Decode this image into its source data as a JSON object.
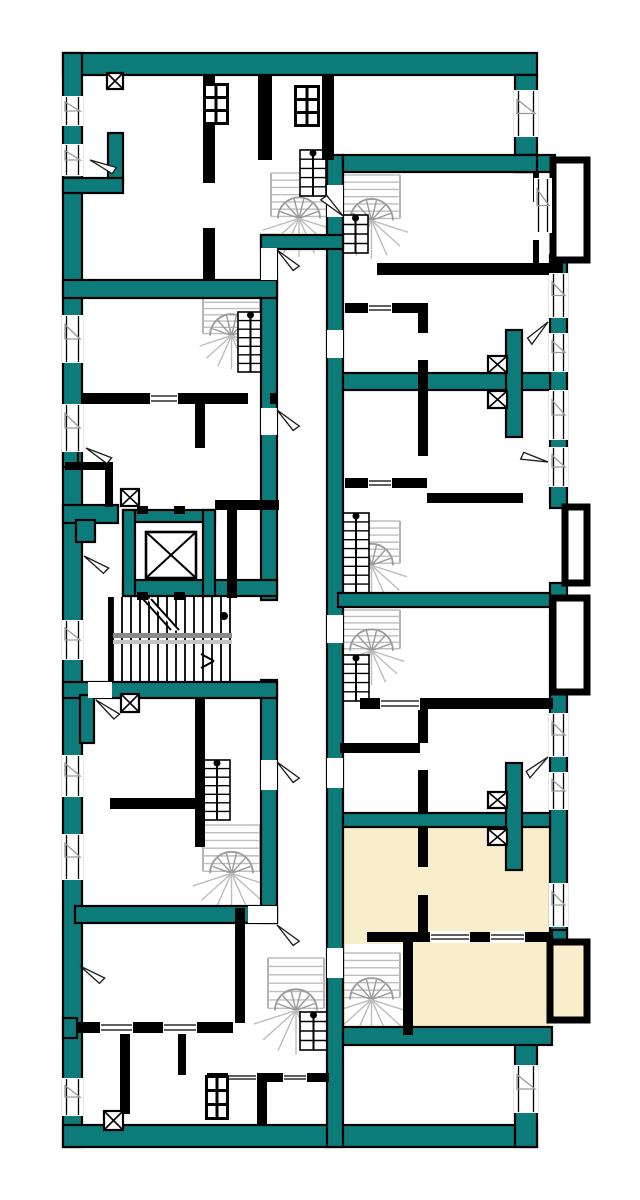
{
  "canvas": {
    "width": 640,
    "height": 1200,
    "background": "#ffffff"
  },
  "palette": {
    "wall_teal": "#0e7b7b",
    "wall_outline": "#000000",
    "wall_black": "#000000",
    "stair_gray": "#9a9a9a",
    "stair_light": "#bdbdbd",
    "rail_dark": "#8a8a8a",
    "rail_light": "#c4c4c4",
    "highlight_cream": "#f8eecb",
    "white": "#ffffff",
    "door_line": "#1a1a1a",
    "window_flag": "#9a9a9a"
  },
  "legend": {
    "teal_wall": "load-bearing-wall",
    "black_wall": "partition-wall",
    "cream_area": "highlighted-apartment",
    "x_box_small": "ventilation-shaft",
    "x_box_large": "elevator-shaft",
    "fan_symbol": "spiral-staircase",
    "tread_symbol": "main-staircase",
    "triangle_symbol": "door-swing",
    "double_line": "window"
  },
  "teal_walls": [
    [
      63,
      53,
      474,
      22
    ],
    [
      63,
      53,
      19,
      1094
    ],
    [
      63,
      1125,
      474,
      22
    ],
    [
      515,
      75,
      22,
      97
    ],
    [
      515,
      155,
      40,
      17
    ],
    [
      550,
      255,
      17,
      253
    ],
    [
      550,
      583,
      17,
      360
    ],
    [
      515,
      1043,
      22,
      104
    ],
    [
      327,
      155,
      16,
      992
    ],
    [
      261,
      235,
      16,
      365
    ],
    [
      261,
      680,
      16,
      243
    ],
    [
      261,
      235,
      82,
      14
    ],
    [
      63,
      280,
      214,
      18
    ],
    [
      123,
      580,
      154,
      16
    ],
    [
      63,
      682,
      214,
      16
    ],
    [
      75,
      906,
      202,
      17
    ],
    [
      343,
      155,
      194,
      17
    ],
    [
      343,
      373,
      207,
      17
    ],
    [
      506,
      330,
      16,
      107
    ],
    [
      343,
      813,
      207,
      14
    ],
    [
      506,
      763,
      16,
      107
    ],
    [
      343,
      1027,
      209,
      18
    ],
    [
      338,
      593,
      212,
      14
    ],
    [
      108,
      133,
      15,
      50
    ],
    [
      63,
      178,
      60,
      15
    ],
    [
      63,
      450,
      15,
      17
    ],
    [
      63,
      505,
      55,
      18
    ],
    [
      76,
      520,
      19,
      22
    ],
    [
      80,
      695,
      14,
      48
    ],
    [
      63,
      1018,
      14,
      20
    ],
    [
      123,
      510,
      92,
      12
    ],
    [
      123,
      510,
      12,
      86
    ],
    [
      203,
      510,
      12,
      86
    ],
    [
      552,
      930,
      15,
      16
    ]
  ],
  "black_walls": [
    [
      203,
      75,
      12,
      108
    ],
    [
      203,
      228,
      12,
      52
    ],
    [
      258,
      75,
      14,
      85
    ],
    [
      322,
      75,
      12,
      85
    ],
    [
      377,
      263,
      186,
      12
    ],
    [
      345,
      303,
      75,
      10
    ],
    [
      418,
      303,
      10,
      30
    ],
    [
      418,
      360,
      10,
      30
    ],
    [
      345,
      478,
      82,
      10
    ],
    [
      418,
      390,
      10,
      66
    ],
    [
      427,
      493,
      96,
      10
    ],
    [
      533,
      172,
      6,
      30
    ],
    [
      533,
      240,
      6,
      25
    ],
    [
      360,
      698,
      193,
      11
    ],
    [
      418,
      709,
      10,
      34
    ],
    [
      418,
      770,
      10,
      43
    ],
    [
      340,
      743,
      80,
      10
    ],
    [
      418,
      827,
      10,
      40
    ],
    [
      418,
      895,
      10,
      37
    ],
    [
      367,
      932,
      186,
      10
    ],
    [
      403,
      942,
      10,
      93
    ],
    [
      82,
      393,
      166,
      11
    ],
    [
      270,
      393,
      7,
      11
    ],
    [
      195,
      403,
      10,
      45
    ],
    [
      65,
      462,
      48,
      8
    ],
    [
      105,
      462,
      8,
      45
    ],
    [
      215,
      500,
      64,
      10
    ],
    [
      227,
      510,
      10,
      88
    ],
    [
      195,
      698,
      10,
      100
    ],
    [
      110,
      798,
      95,
      11
    ],
    [
      195,
      809,
      10,
      38
    ],
    [
      235,
      908,
      10,
      115
    ],
    [
      77,
      1022,
      156,
      11
    ],
    [
      120,
      1032,
      10,
      82
    ],
    [
      178,
      1022,
      8,
      53
    ],
    [
      207,
      1073,
      122,
      9
    ],
    [
      257,
      1082,
      10,
      44
    ],
    [
      108,
      597,
      5,
      85
    ]
  ],
  "balconies": [
    {
      "x": 553,
      "y": 160,
      "w": 34,
      "h": 100,
      "fill": "white"
    },
    {
      "x": 565,
      "y": 507,
      "w": 22,
      "h": 76,
      "fill": "white"
    },
    {
      "x": 553,
      "y": 598,
      "w": 34,
      "h": 94,
      "fill": "white"
    },
    {
      "x": 550,
      "y": 942,
      "w": 37,
      "h": 78,
      "fill": "cream"
    }
  ],
  "highlight_areas": [
    [
      343,
      827,
      207,
      200
    ],
    [
      552,
      944,
      33,
      74
    ]
  ],
  "white_patches": [
    [
      345,
      944,
      58,
      88
    ]
  ],
  "windows_v": [
    [
      63,
      96,
      19,
      30
    ],
    [
      63,
      144,
      19,
      32
    ],
    [
      63,
      315,
      19,
      48
    ],
    [
      63,
      404,
      19,
      48
    ],
    [
      63,
      620,
      19,
      40
    ],
    [
      63,
      755,
      19,
      42
    ],
    [
      63,
      834,
      19,
      46
    ],
    [
      63,
      1078,
      19,
      38
    ],
    [
      515,
      90,
      22,
      47
    ],
    [
      550,
      273,
      17,
      45
    ],
    [
      550,
      333,
      17,
      39
    ],
    [
      550,
      390,
      17,
      50
    ],
    [
      550,
      447,
      17,
      40
    ],
    [
      550,
      713,
      17,
      44
    ],
    [
      550,
      772,
      17,
      38
    ],
    [
      550,
      883,
      17,
      44
    ],
    [
      515,
      1065,
      22,
      48
    ],
    [
      535,
      178,
      16,
      55
    ]
  ],
  "windows_h": [
    [
      368,
      303,
      24,
      10
    ],
    [
      368,
      478,
      24,
      10
    ],
    [
      380,
      698,
      40,
      11
    ],
    [
      430,
      932,
      40,
      10
    ],
    [
      490,
      932,
      35,
      10
    ],
    [
      228,
      1073,
      29,
      9
    ],
    [
      283,
      1073,
      24,
      9
    ],
    [
      100,
      1022,
      33,
      11
    ],
    [
      163,
      1022,
      34,
      11
    ],
    [
      150,
      393,
      28,
      11
    ]
  ],
  "door_gaps": [
    [
      261,
      248,
      16,
      32
    ],
    [
      261,
      408,
      16,
      27
    ],
    [
      261,
      760,
      16,
      30
    ],
    [
      248,
      906,
      29,
      17
    ],
    [
      327,
      185,
      16,
      32
    ],
    [
      327,
      330,
      16,
      28
    ],
    [
      327,
      615,
      16,
      28
    ],
    [
      327,
      758,
      16,
      30
    ],
    [
      327,
      948,
      16,
      30
    ],
    [
      88,
      682,
      24,
      16
    ]
  ],
  "door_arcs": [
    [
      90,
      160,
      35
    ],
    [
      277,
      250,
      55
    ],
    [
      343,
      216,
      -125
    ],
    [
      548,
      322,
      145
    ],
    [
      548,
      462,
      -155
    ],
    [
      86,
      448,
      40
    ],
    [
      277,
      410,
      55
    ],
    [
      84,
      556,
      45
    ],
    [
      548,
      757,
      150
    ],
    [
      277,
      762,
      55
    ],
    [
      80,
      966,
      45
    ],
    [
      277,
      925,
      55
    ],
    [
      96,
      700,
      50
    ]
  ],
  "vents": [
    [
      107,
      73,
      16,
      16
    ],
    [
      488,
      356,
      19,
      17
    ],
    [
      488,
      391,
      19,
      17
    ],
    [
      121,
      489,
      18,
      17
    ],
    [
      121,
      694,
      18,
      18
    ],
    [
      488,
      792,
      19,
      16
    ],
    [
      488,
      829,
      19,
      16
    ],
    [
      104,
      1111,
      19,
      19
    ]
  ],
  "ducts": [
    [
      203,
      83,
      26,
      42
    ],
    [
      294,
      85,
      26,
      42
    ],
    [
      205,
      1075,
      24,
      45
    ]
  ],
  "spiral_stairs": [
    [
      268,
      170,
      62,
      80
    ],
    [
      340,
      172,
      63,
      80
    ],
    [
      200,
      293,
      63,
      70
    ],
    [
      340,
      518,
      63,
      78
    ],
    [
      340,
      607,
      63,
      72
    ],
    [
      200,
      822,
      63,
      85
    ],
    [
      265,
      955,
      62,
      92
    ],
    [
      340,
      950,
      63,
      82
    ]
  ],
  "ladders": [
    [
      300,
      150,
      26,
      46
    ],
    [
      343,
      215,
      25,
      38
    ],
    [
      238,
      312,
      25,
      60
    ],
    [
      343,
      513,
      26,
      80
    ],
    [
      343,
      655,
      26,
      46
    ],
    [
      204,
      760,
      26,
      60
    ],
    [
      300,
      1012,
      27,
      38
    ]
  ],
  "main_stair": {
    "x": 113,
    "y": 597,
    "w": 117,
    "h": 85,
    "treads": 13
  },
  "elevator": {
    "cab": {
      "x": 146,
      "y": 532,
      "w": 50,
      "h": 46
    },
    "tabs": [
      [
        137,
        506,
        11,
        8
      ],
      [
        174,
        506,
        11,
        8
      ],
      [
        137,
        592,
        11,
        8
      ],
      [
        174,
        592,
        11,
        8
      ]
    ]
  }
}
